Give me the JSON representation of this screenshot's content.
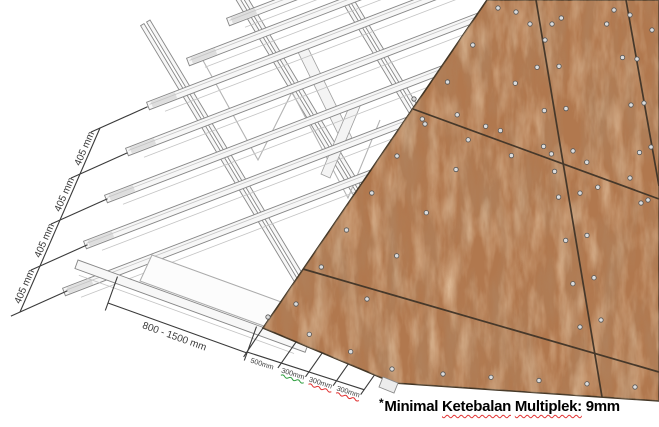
{
  "diagram": {
    "dimensions": {
      "batten_spacing": [
        "405 mm",
        "405 mm",
        "405 mm",
        "405 mm"
      ],
      "truss_span": "800 - 1500 mm",
      "screw_edge_distance": "500mm",
      "screw_spacing": [
        "300mm",
        "300mm",
        "300mm"
      ]
    },
    "note": {
      "bullet": "*",
      "text_before": "Minimal ",
      "underlined_word_1": "Ketebalan",
      "separator": " ",
      "underlined_word_2": "Multiplek:",
      "text_after": " 9mm"
    },
    "colors": {
      "wood": "#b1784e",
      "wood_seam": "#46382a",
      "red_label": "#cc2222",
      "green_underline": "#2e9e3e",
      "red_underline": "#e03131",
      "dimension_line": "#3a3a3a",
      "steel": "#878787"
    }
  }
}
